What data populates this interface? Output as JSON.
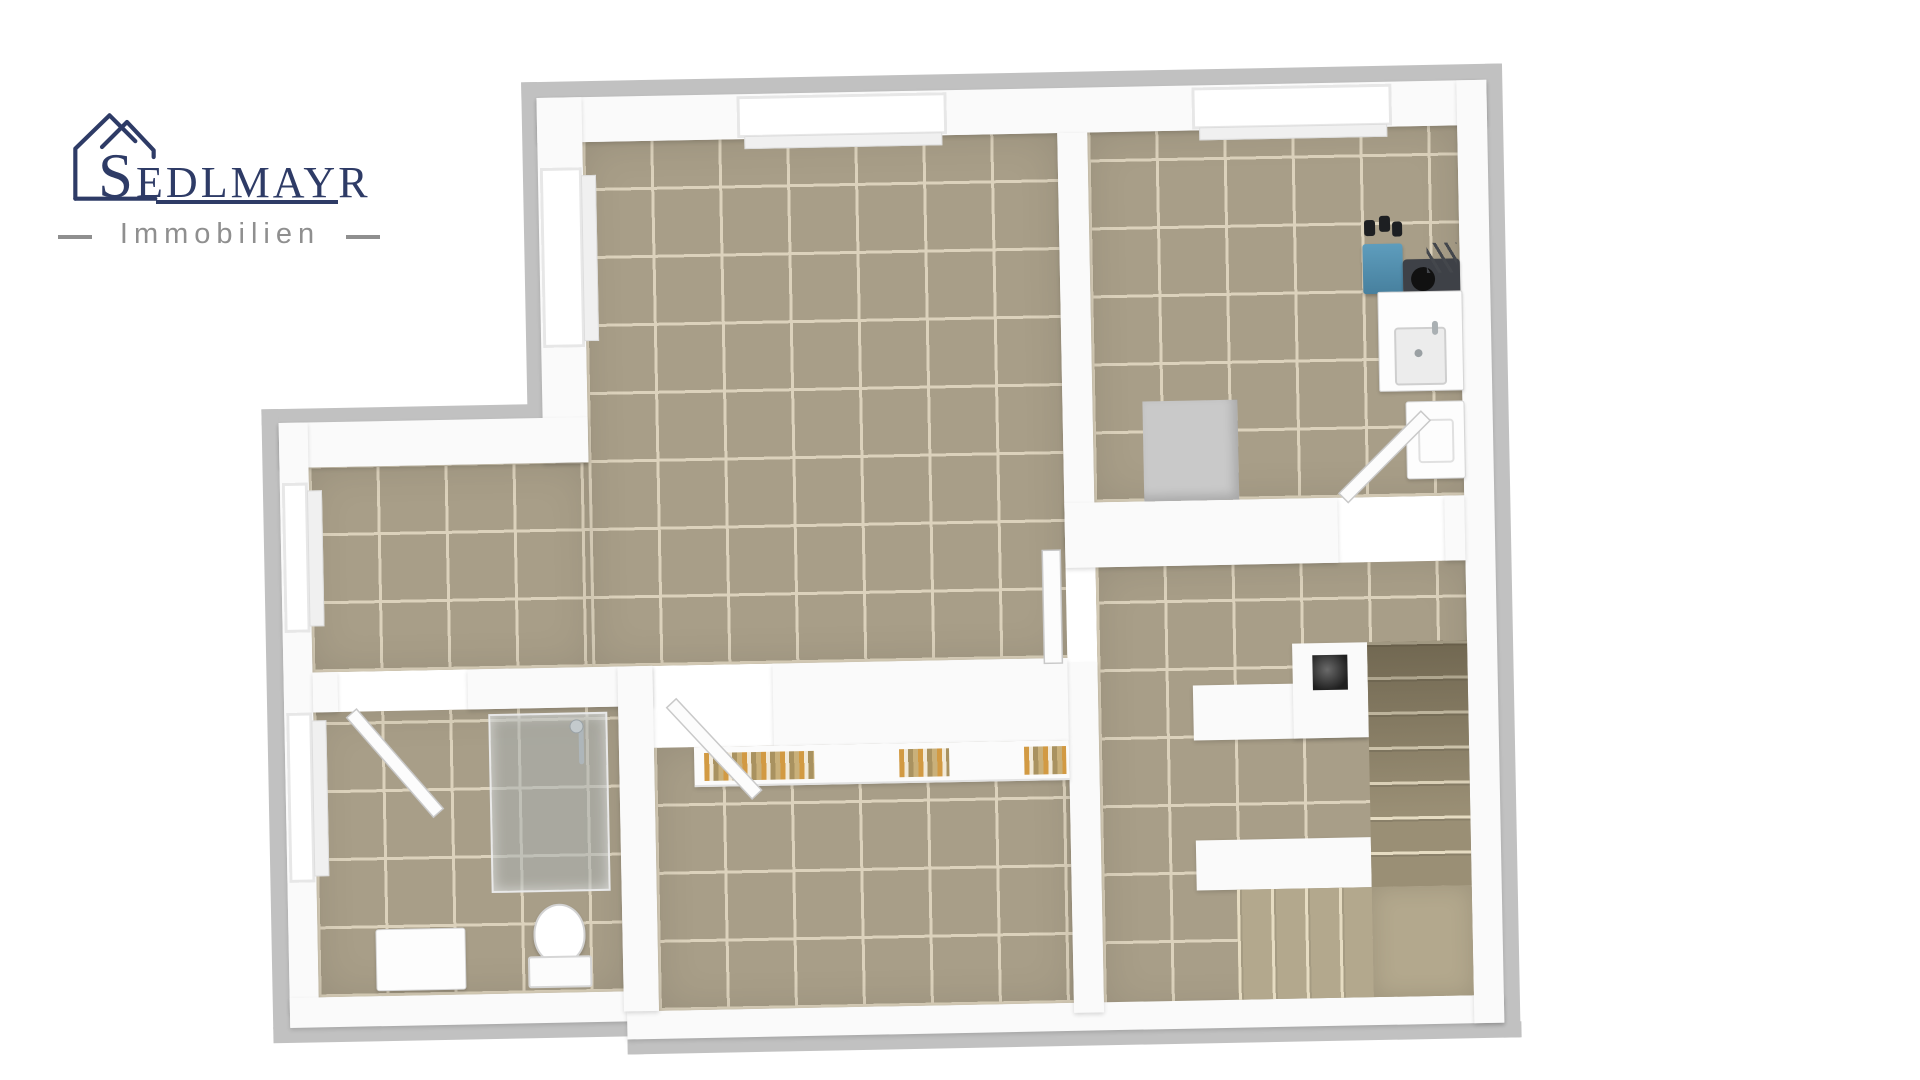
{
  "page": {
    "background_color": "#ffffff"
  },
  "logo": {
    "icon": "house-outline-icon",
    "brand_text": "SEDLMAYR",
    "subtitle_text": "Immobilien",
    "colors": {
      "logo_navy": "#2e3b66",
      "logo_gray": "#8f8f8f"
    }
  },
  "floorplan": {
    "colors": {
      "floor_tile": "#a89e88",
      "tile_grout": "#dcd2bc",
      "wall_white": "#fafafa",
      "wall_cap": "#c1c1c1",
      "glass_gray": "#aab0b3",
      "boiler_blue": "#5e9dbd",
      "equipment_dark": "#3e4147",
      "pipe_black": "#1d1f22",
      "chimney_gray": "#c9c9c9",
      "stair_upper": "#9a8f75",
      "stair_lower": "#b3a88d",
      "step_edge": "#e6dcc2",
      "book_orange": "#d29a43"
    }
  }
}
